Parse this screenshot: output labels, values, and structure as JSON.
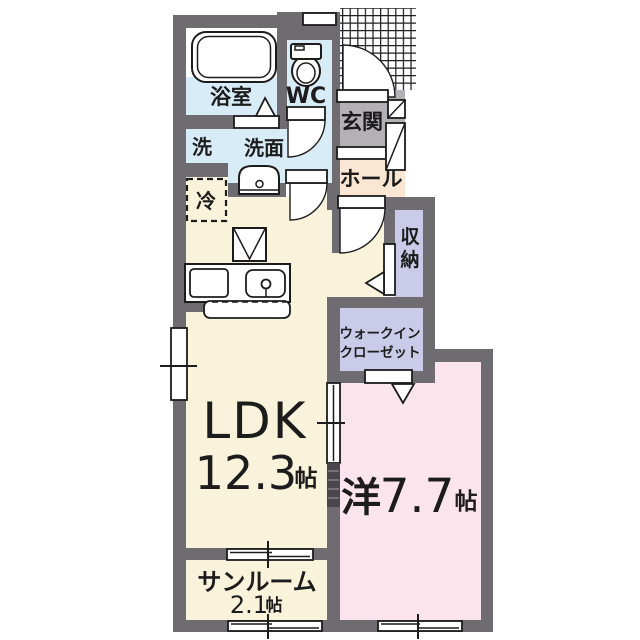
{
  "plan": {
    "rooms": {
      "ldk": {
        "name": "LDK",
        "size": "12.3",
        "unit": "帖"
      },
      "western": {
        "prefix": "洋",
        "size": "7.7",
        "unit": "帖"
      },
      "sunroom": {
        "name": "サンルーム",
        "size": "2.1",
        "unit": "帖"
      },
      "bathroom": {
        "name": "浴室"
      },
      "toilet": {
        "name": "WC"
      },
      "washroom": {
        "name": "洗面"
      },
      "washer": {
        "name": "洗"
      },
      "refrigerator су": {
        "name": ""
      },
      "fridge": {
        "name": "冷"
      },
      "entrance": {
        "name": "玄関"
      },
      "hall": {
        "name": "ホール"
      },
      "closet": {
        "char1": "収",
        "char2": "納"
      },
      "walkin": {
        "line1": "ウォークイン",
        "line2": "クローゼット"
      }
    },
    "colors": {
      "cream": "#FAF3DC",
      "pink": "#FCE4ED",
      "lavender": "#C9CBE9",
      "blue": "#D8ECF7",
      "peach": "#FBE5D3",
      "genkan": "#B3B1B5",
      "white": "#FFFFFF"
    }
  }
}
